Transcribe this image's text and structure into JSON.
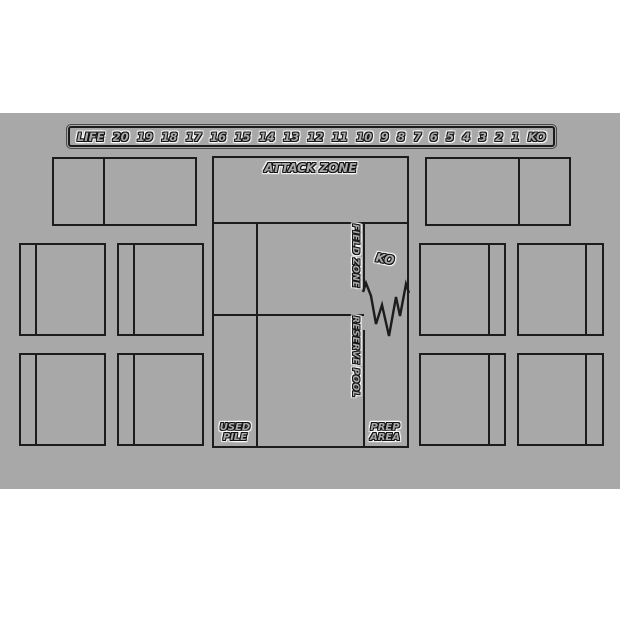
{
  "colors": {
    "page_background": "#ffffff",
    "mat_background": "#a8a8a8",
    "line": "#1c1c1c",
    "text_outline": "#141414",
    "text_halo": "#ffffff"
  },
  "life_track": {
    "label": "LIFE",
    "values": [
      "20",
      "19",
      "18",
      "17",
      "16",
      "15",
      "14",
      "13",
      "12",
      "11",
      "10",
      "9",
      "8",
      "7",
      "6",
      "5",
      "4",
      "3",
      "2",
      "1",
      "KO"
    ]
  },
  "zones": {
    "attack": "ATTACK ZONE",
    "field": "FIELD ZONE",
    "reserve": "RESERVE POOL",
    "used_pile": "USED PILE",
    "prep_area": "PREP AREA",
    "ko": "KO"
  }
}
